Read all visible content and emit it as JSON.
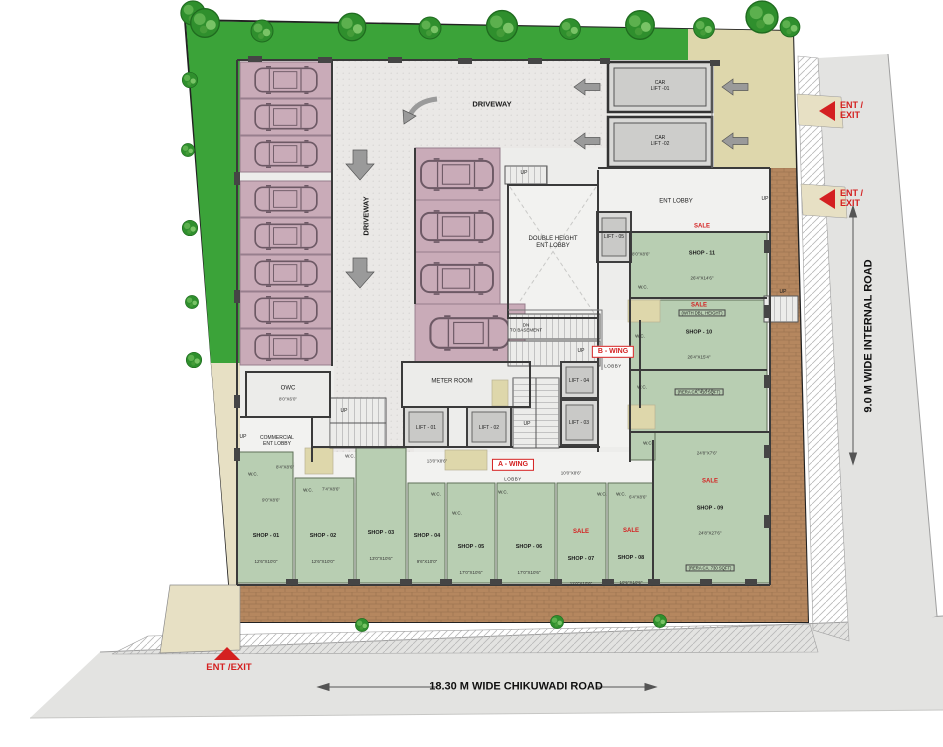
{
  "plan": {
    "driveway_horizontal": "DRIVEWAY",
    "driveway_vertical": "DRIVEWAY",
    "double_height_lobby": "DOUBLE HEIGHT\nENT LOBBY",
    "ent_lobby": "ENT LOBBY",
    "meter_room": "METER ROOM",
    "owc": "OWC",
    "owc_dim": "8'0\"X6'0\"",
    "commercial_lobby": "COMMERCIAL\nENT LOBBY",
    "a_wing": "A - WING",
    "b_wing": "B - WING",
    "wing_sub": "LOBBY",
    "dn_to_basement": "DN\nTO BASEMENT",
    "up": "UP",
    "wc": "W.C."
  },
  "lifts": {
    "car_lift_1": "CAR\nLIFT -01",
    "car_lift_2": "CAR\nLIFT -02",
    "lift_1": "LIFT - 01",
    "lift_2": "LIFT - 02",
    "lift_3": "LIFT - 03",
    "lift_4": "LIFT - 04",
    "lift_5": "LIFT - 05"
  },
  "shops": [
    {
      "name": "SHOP - 01",
      "dim": "12'6\"X10'0\""
    },
    {
      "name": "SHOP - 02",
      "dim": "12'6\"X10'0\""
    },
    {
      "name": "SHOP - 03",
      "dim": "13'0\"X10'6\""
    },
    {
      "name": "SHOP - 04",
      "dim": "9'6\"X10'0\""
    },
    {
      "name": "SHOP - 05",
      "dim": "17'0\"X10'6\""
    },
    {
      "name": "SHOP - 06",
      "dim": "17'0\"X10'6\""
    },
    {
      "sale": "SALE",
      "name": "SHOP - 07",
      "dim": "11'0\"X10'6\""
    },
    {
      "sale": "SALE",
      "name": "SHOP - 08",
      "dim": "10'6\"X10'6\""
    },
    {
      "sale": "SALE",
      "name": "SHOP - 09",
      "dim": "24'8\"X27'6\"",
      "extra": "(RERA CA. 730 SQFT)"
    },
    {
      "sale": "SALE",
      "name": "SHOP - 10",
      "dim": "26'4\"X15'4\"",
      "extra": "(RERA CA. 410 SQFT)"
    },
    {
      "sale": "SALE",
      "name": "SHOP - 11",
      "dim": "26'4\"X14'6\"",
      "extra": "(WITH DBL. HEIGHT)"
    }
  ],
  "dims": [
    "8'4\"X8'6\"",
    "9'0\"X8'6\"",
    "7'4\"X8'6\"",
    "13'0\"X8'6\"",
    "10'0\"X8'6\"",
    "6'4\"X8'6\"",
    "24'8\"X7'6\"",
    "8'0\"X8'6\""
  ],
  "roads": {
    "bottom": "18.30 M WIDE  CHIKUWADI ROAD",
    "right": "9.0 M WIDE  INTERNAL ROAD"
  },
  "entries": {
    "right_1": "ENT /\nEXIT",
    "right_2": "ENT /\nEXIT",
    "bottom": "ENT /EXIT"
  },
  "colors": {
    "accent_red": "#d42020",
    "lawn_green": "#3ba339",
    "shop_green": "#b8ceb2",
    "stall_pink": "#c9abb8",
    "paving_brown": "#b5875f",
    "khaki": "#ded7ac"
  }
}
